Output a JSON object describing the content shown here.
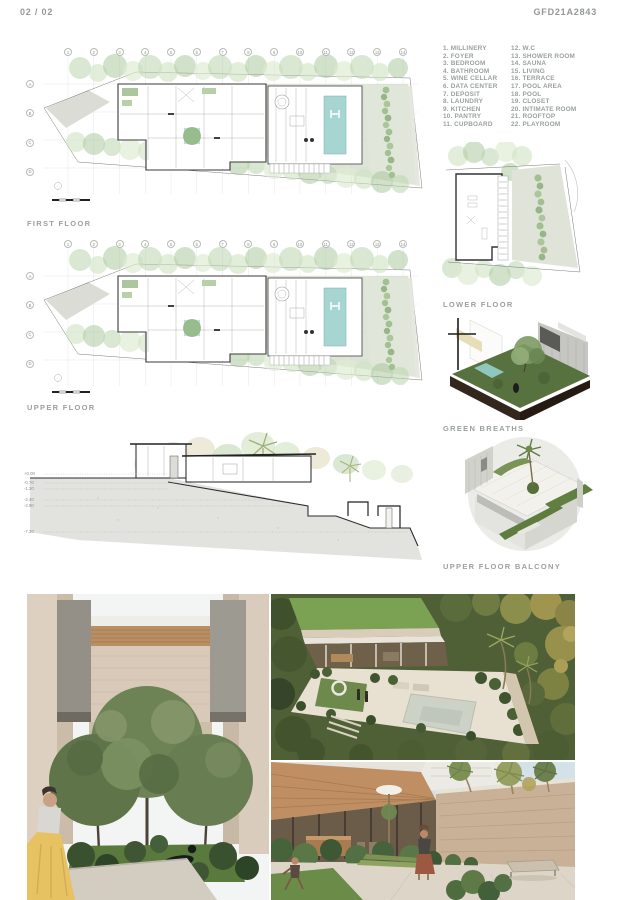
{
  "header": {
    "page": "02 / 02",
    "code": "GFD21A2843"
  },
  "legend": {
    "col1": [
      "1. MILLINERY",
      "2. FOYER",
      "3. BEDROOM",
      "4. BATHROOM",
      "5. WINE CELLAR",
      "6. DATA CENTER",
      "7. DEPOSIT",
      "8. LAUNDRY",
      "9. KITCHEN",
      "10. PANTRY",
      "11. CUPBOARD"
    ],
    "col2": [
      "12. W.C",
      "13. SHOWER ROOM",
      "14. SAUNA",
      "15. LIVING",
      "16. TERRACE",
      "17. POOL AREA",
      "18. POOL",
      "19. CLOSET",
      "20. INTIMATE ROOM",
      "21. ROOFTOP",
      "22. PLAYROOM"
    ]
  },
  "grid": {
    "cols": [
      "1",
      "2",
      "3",
      "4",
      "5",
      "6",
      "7",
      "8",
      "9",
      "10",
      "11",
      "12",
      "13",
      "14"
    ],
    "rows": [
      "A",
      "B",
      "C",
      "D"
    ]
  },
  "plans": {
    "first": {
      "label": "FIRST FLOOR"
    },
    "upper": {
      "label": "UPPER FLOOR"
    },
    "lower": {
      "label": "LOWER FLOOR"
    },
    "green_breaths": {
      "label": "GREEN BREATHS"
    },
    "balcony": {
      "label": "UPPER FLOOR BALCONY"
    }
  },
  "section": {
    "levels": [
      "+0.00",
      "-0.70",
      "-1.20",
      "-2.40",
      "-2.90",
      "-7.20"
    ]
  },
  "colors": {
    "pool": "#a7d6d2",
    "lawn": "#ccd6c1",
    "tree_green": "#bcd5ae",
    "label_gray": "#9ba19c",
    "soil_brown": "#3a2b21",
    "grass_render": "#5d7a3f",
    "travertine": "#d8c9b8",
    "wood": "#b98e62",
    "dress_yellow": "#e6c263"
  }
}
